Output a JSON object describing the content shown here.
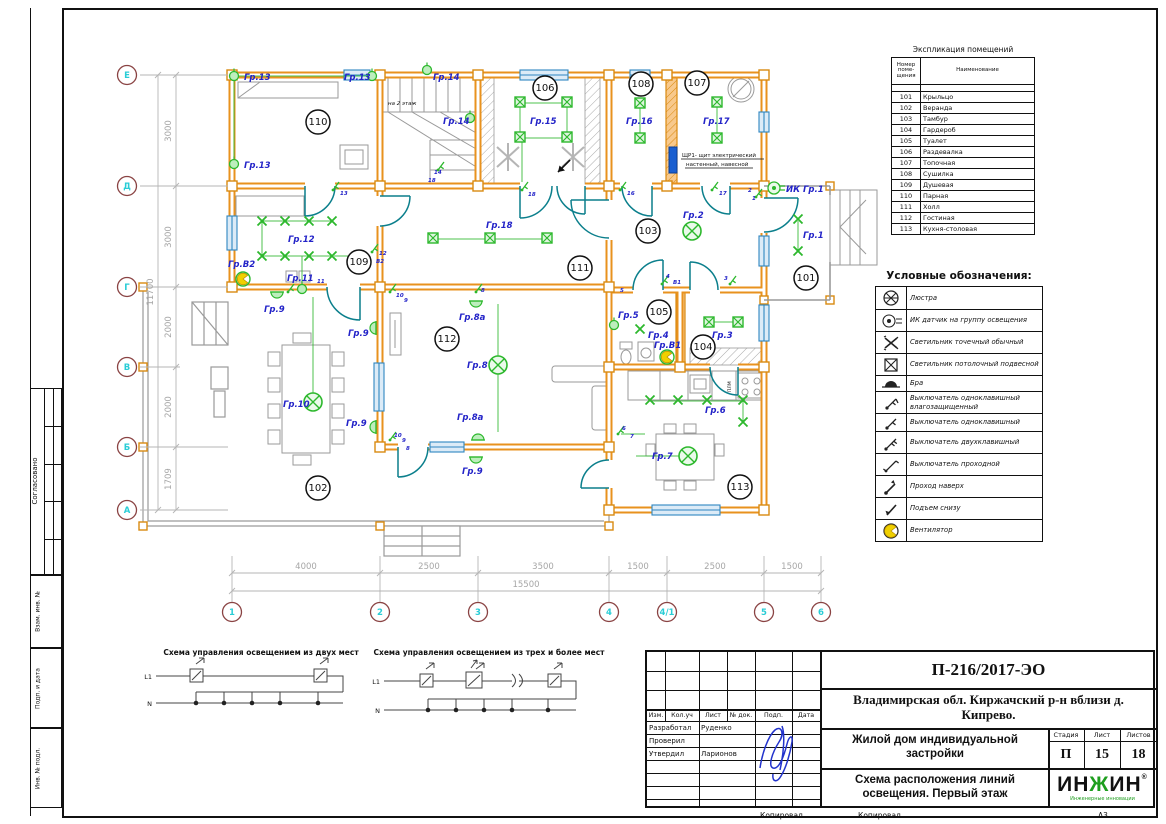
{
  "page": {
    "copy1": "Копировал",
    "copy2": "Копировал",
    "format": "А3"
  },
  "margin": {
    "approved": "Согласовано",
    "stamp1": "Взам. инв. №",
    "stamp2": "Подп. и дата",
    "stamp3": "Инв. № подл."
  },
  "explication": {
    "title": "Экспликация помещений",
    "col_num": "Номер поме- щения",
    "col_name": "Наименование",
    "rows": [
      {
        "num": "101",
        "name": "Крыльцо"
      },
      {
        "num": "102",
        "name": "Веранда"
      },
      {
        "num": "103",
        "name": "Тамбур"
      },
      {
        "num": "104",
        "name": "Гардероб"
      },
      {
        "num": "105",
        "name": "Туалет"
      },
      {
        "num": "106",
        "name": "Раздевалка"
      },
      {
        "num": "107",
        "name": "Топочная"
      },
      {
        "num": "108",
        "name": "Сушилка"
      },
      {
        "num": "109",
        "name": "Душевая"
      },
      {
        "num": "110",
        "name": "Парная"
      },
      {
        "num": "111",
        "name": "Холл"
      },
      {
        "num": "112",
        "name": "Гостиная"
      },
      {
        "num": "113",
        "name": "Кухня-столовая"
      }
    ]
  },
  "legend": {
    "title": "Условные обозначения:",
    "items": [
      {
        "icon": "chandelier-icon",
        "label": "Люстра"
      },
      {
        "icon": "ir-sensor-icon",
        "label": "ИК датчик на группу освещения"
      },
      {
        "icon": "spot-light-icon",
        "label": "Светильник точечный обычный"
      },
      {
        "icon": "pendant-light-icon",
        "label": "Светильник потолочный подвесной"
      },
      {
        "icon": "sconce-icon",
        "label": "Бра"
      },
      {
        "icon": "switch-1-wp-icon",
        "label": "Выключатель одноклавишный влагозащищенный"
      },
      {
        "icon": "switch-1-icon",
        "label": "Выключатель одноклавишный"
      },
      {
        "icon": "switch-2-icon",
        "label": "Выключатель двухклавишный"
      },
      {
        "icon": "switch-pass-icon",
        "label": "Выключатель проходной"
      },
      {
        "icon": "pass-up-icon",
        "label": "Проход наверх"
      },
      {
        "icon": "rise-below-icon",
        "label": "Подъем снизу"
      },
      {
        "icon": "fan-icon",
        "label": "Вентилятор"
      }
    ]
  },
  "schemes": {
    "s1_title": "Схема управления освещением из двух мест",
    "s2_title": "Схема управления освещением из трех и более мест",
    "l1": "L1",
    "n": "N"
  },
  "titleblock": {
    "code": "П-216/2017-ЭО",
    "location": "Владимирская обл. Киржачский р-н вблизи д. Кипрево.",
    "object": "Жилой дом индивидуальной застройки",
    "sheet_title": "Схема расположения линий освещения. Первый этаж",
    "cols": [
      "Изм.",
      "Кол.уч",
      "Лист",
      "№ док.",
      "Подп.",
      "Дата"
    ],
    "rows": [
      {
        "role": "Разработал",
        "name": "Руденко"
      },
      {
        "role": "Проверил",
        "name": ""
      },
      {
        "role": "Утвердил",
        "name": "Ларионов"
      }
    ],
    "stage_label": "Стадия",
    "sheet_label": "Лист",
    "sheets_label": "Листов",
    "stage": "П",
    "sheet": "15",
    "sheets": "18",
    "logo_p1": "ИН",
    "logo_p2": "Ж",
    "logo_p3": "ИН",
    "logo_sub": "Инженерные инновации",
    "reg": "®"
  },
  "plan": {
    "axes_cols": [
      "1",
      "2",
      "3",
      "4",
      "4/1",
      "5",
      "6"
    ],
    "axes_rows": [
      "Е",
      "Д",
      "Г",
      "В",
      "Б",
      "А"
    ],
    "dims_bottom": [
      "4000",
      "2500",
      "3500",
      "1500",
      "2500",
      "1500"
    ],
    "dim_bottom_total": "15500",
    "dims_left": [
      "3000",
      "3000",
      "2000",
      "2000",
      "1709"
    ],
    "dim_left_total": "11700",
    "rooms": {
      "r101": "101",
      "r102": "102",
      "r103": "103",
      "r104": "104",
      "r105": "105",
      "r106": "106",
      "r107": "107",
      "r108": "108",
      "r109": "109",
      "r110": "110",
      "r111": "111",
      "r112": "112",
      "r113": "113"
    },
    "groups": {
      "g1": "Гр.1",
      "g2": "Гр.2",
      "g3": "Гр.3",
      "g4": "Гр.4",
      "g5": "Гр.5",
      "g6": "Гр.6",
      "g7": "Гр.7",
      "g8": "Гр.8",
      "g8a": "Гр.8а",
      "g9": "Гр.9",
      "g10": "Гр.10",
      "g11": "Гр.11",
      "g12": "Гр.12",
      "g13": "Гр.13",
      "g14": "Гр.14",
      "g15": "Гр.15",
      "g16": "Гр.16",
      "g17": "Гр.17",
      "g18": "Гр.18",
      "gv1": "Гр.В1",
      "gv2": "Гр.В2",
      "ik1": "ИК Гр.1"
    },
    "nums": {
      "n1": "1",
      "n2": "2",
      "n3": "3",
      "n4": "4",
      "n5": "5",
      "n6": "6",
      "n7": "7",
      "n8": "8",
      "n9": "9",
      "n10": "10",
      "n11": "11",
      "n12": "12",
      "n13": "13",
      "n14": "14",
      "n16": "16",
      "n17": "17",
      "n18": "18",
      "nv1": "В1",
      "nv2": "В2"
    },
    "misc": {
      "shield1": "ЩР1- щит электрический",
      "shield2": "настенный, навесной",
      "stairs_up": "на 2 этаж",
      "stove": "ПЛМ"
    }
  },
  "colors": {
    "wall": "#e8921e",
    "light_green": "#2db82d",
    "label_blue": "#2323c8",
    "door_teal": "#0b7f8c",
    "window_blue": "#2e86c1",
    "axis_cyan": "#29cdd6",
    "axis_ring": "#8a4343",
    "dim_gray": "#a6a6a6",
    "signature_blue": "#2233cc",
    "logo_green": "#1e9e1e",
    "panel_blue": "#1a5fd0"
  }
}
